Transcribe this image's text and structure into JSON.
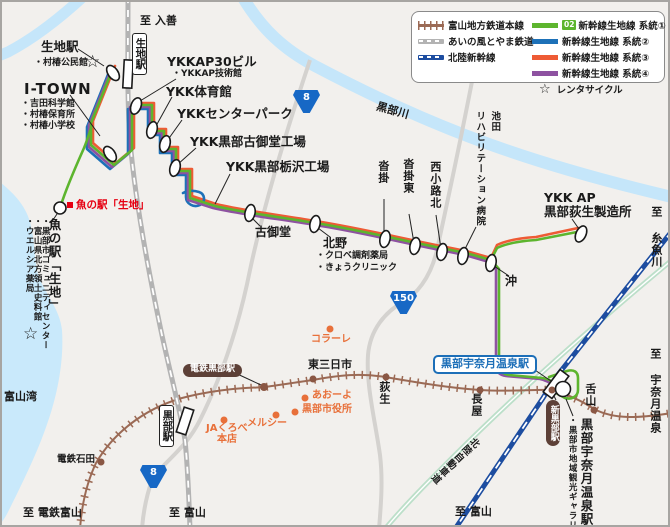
{
  "colors": {
    "background": "#f2f0ed",
    "sea": "#c9e9fb",
    "river": "#c5e6fa",
    "road": "#d4d2cf",
    "chitetsu": "#9b6a55",
    "ainokaze": "#b3b3b3",
    "shinkansen": "#1d4da0",
    "expressway": "#bcdfc9",
    "route1_green": "#5db52e",
    "route2_blue": "#1d71b8",
    "route3_orange": "#ee5b35",
    "route4_purple": "#8e52a1",
    "poi_orange": "#e8703a",
    "poi_red": "#e60012",
    "shield_blue": "#1768c5",
    "badge_brown": "#5d4037",
    "station_blue": "#1d6fb8"
  },
  "legend": {
    "rail_items": [
      {
        "label": "富山地方鉄道本線",
        "type": "chitetsu"
      },
      {
        "label": "あいの風とやま鉄道",
        "type": "ainokaze"
      },
      {
        "label": "北陸新幹線",
        "type": "shinkansen"
      }
    ],
    "route_items": [
      {
        "badge": "02",
        "label": "新幹線生地線 系統①",
        "color": "#5db52e"
      },
      {
        "badge": "",
        "label": "新幹線生地線 系統②",
        "color": "#1d71b8"
      },
      {
        "badge": "",
        "label": "新幹線生地線 系統③",
        "color": "#ee5b35"
      },
      {
        "badge": "",
        "label": "新幹線生地線 系統④",
        "color": "#8e52a1"
      }
    ],
    "rental_cycle_label": "レンタサイクル",
    "rental_cycle_icon": "star-icon"
  },
  "map_labels": [
    {
      "name": "to-nyuzen-label",
      "text": "至 入善",
      "x": 140,
      "y": 15,
      "cls": "md"
    },
    {
      "name": "ikuji-bus-stop-label",
      "text": "生地駅",
      "x": 41,
      "y": 40,
      "cls": "lg"
    },
    {
      "name": "muratsubaki-kominkan-label",
      "text": "・村椿公民館",
      "x": 34,
      "y": 59,
      "cls": "sm"
    },
    {
      "name": "i-town-label",
      "text": "I-TOWN",
      "x": 24,
      "y": 81,
      "cls": "xl"
    },
    {
      "name": "yoshida-science-label",
      "text": "・吉田科学館",
      "x": 21,
      "y": 100,
      "cls": "sm"
    },
    {
      "name": "muratsubaki-hoiku-label",
      "text": "・村椿保育所",
      "x": 21,
      "y": 111,
      "cls": "sm"
    },
    {
      "name": "muratsubaki-shogakko-label",
      "text": "・村椿小学校",
      "x": 21,
      "y": 122,
      "cls": "sm"
    },
    {
      "name": "ikuji-rail-station-box",
      "text": "生地駅",
      "x": 132,
      "y": 33,
      "cls": "stationbox"
    },
    {
      "name": "ykkap30-label",
      "text": "YKKAP30ビル",
      "x": 167,
      "y": 55,
      "cls": "lg"
    },
    {
      "name": "ykkap-gijutsukan-label",
      "text": "・YKKAP技術館",
      "x": 172,
      "y": 70,
      "cls": "sm"
    },
    {
      "name": "ykk-taiikukan-label",
      "text": "YKK体育館",
      "x": 166,
      "y": 85,
      "cls": "lg"
    },
    {
      "name": "ykk-center-park-label",
      "text": "YKKセンターパーク",
      "x": 177,
      "y": 107,
      "cls": "lg"
    },
    {
      "name": "ykk-komido-kojo-label",
      "text": "YKK黒部古御堂工場",
      "x": 190,
      "y": 135,
      "cls": "lg"
    },
    {
      "name": "ykk-tochizawa-kojo-label",
      "text": "YKK黒部栃沢工場",
      "x": 226,
      "y": 160,
      "cls": "lg"
    },
    {
      "name": "kurobe-river-label",
      "text": "黒部川",
      "x": 376,
      "y": 105,
      "cls": "md",
      "rot": 16
    },
    {
      "name": "ikeda-hospital-label-1",
      "text": "池田",
      "x": 489,
      "y": 111,
      "cls": "vert smd"
    },
    {
      "name": "ikeda-hospital-label-2",
      "text": "リハビリテーション病院",
      "x": 474,
      "y": 111,
      "cls": "vert smd"
    },
    {
      "name": "kutsukake-label",
      "text": "沓掛",
      "x": 377,
      "y": 160,
      "cls": "vert md"
    },
    {
      "name": "kutsukake-higashi-label",
      "text": "沓掛東",
      "x": 402,
      "y": 158,
      "cls": "vert md"
    },
    {
      "name": "nishikoji-kita-label",
      "text": "西小路北",
      "x": 429,
      "y": 161,
      "cls": "vert md"
    },
    {
      "name": "ykk-ap-label-1",
      "text": "YKK AP",
      "x": 544,
      "y": 191,
      "cls": "lg"
    },
    {
      "name": "ykk-ap-label-2",
      "text": "黒部荻生製造所",
      "x": 544,
      "y": 205,
      "cls": "lg"
    },
    {
      "name": "to-itoigawa-label",
      "text": "至 糸魚川",
      "x": 650,
      "y": 206,
      "cls": "vert md"
    },
    {
      "name": "komido-stop-label",
      "text": "古御堂",
      "x": 255,
      "y": 226,
      "cls": "mdd"
    },
    {
      "name": "kitano-stop-label",
      "text": "北野",
      "x": 323,
      "y": 237,
      "cls": "mdd"
    },
    {
      "name": "kurobe-pharmacy-label",
      "text": "・クロベ調剤薬局",
      "x": 316,
      "y": 252,
      "cls": "sm"
    },
    {
      "name": "kyo-clinic-label",
      "text": "・きょうクリニック",
      "x": 316,
      "y": 264,
      "cls": "sm"
    },
    {
      "name": "oki-stop-label",
      "text": "沖",
      "x": 505,
      "y": 275,
      "cls": "mdd"
    },
    {
      "name": "uonoeki-poi-label",
      "text": "魚の駅「生地」",
      "x": 76,
      "y": 200,
      "cls": "red"
    },
    {
      "name": "uonoeki-stop-label",
      "text": "魚の駅「生地」",
      "x": 47,
      "y": 218,
      "cls": "vert lg"
    },
    {
      "name": "community-center-label",
      "text": "・黒部市コミュニティセンター",
      "x": 40,
      "y": 217,
      "cls": "vert xs"
    },
    {
      "name": "hoppo-shiryokan-label",
      "text": "・富山県北方領土史料館",
      "x": 32,
      "y": 217,
      "cls": "vert xs"
    },
    {
      "name": "welcia-label",
      "text": "・ウエルシア薬局",
      "x": 24,
      "y": 217,
      "cls": "vert xs"
    },
    {
      "name": "toyama-bay-label",
      "text": "富山湾",
      "x": 4,
      "y": 391,
      "cls": "md"
    },
    {
      "name": "colare-label",
      "text": "コラーレ",
      "x": 311,
      "y": 335,
      "cls": "poi"
    },
    {
      "name": "dentetsu-kurobe-badge",
      "text": "電鉄黒部駅",
      "x": 183,
      "y": 364,
      "cls": "badge"
    },
    {
      "name": "higashi-mikkaichi-label",
      "text": "東三日市",
      "x": 308,
      "y": 359,
      "cls": "md"
    },
    {
      "name": "aoyo-label",
      "text": "あおーよ",
      "x": 312,
      "y": 391,
      "cls": "poi"
    },
    {
      "name": "kurobe-cityhall-label",
      "text": "黒部市役所",
      "x": 302,
      "y": 405,
      "cls": "poi"
    },
    {
      "name": "mercy-label",
      "text": "メルシー",
      "x": 247,
      "y": 419,
      "cls": "poi"
    },
    {
      "name": "ja-kurobe-label-1",
      "text": "JAくろべ",
      "x": 206,
      "y": 424,
      "cls": "poi"
    },
    {
      "name": "ja-kurobe-label-2",
      "text": "本店",
      "x": 217,
      "y": 435,
      "cls": "poi"
    },
    {
      "name": "ogyu-label",
      "text": "荻生",
      "x": 378,
      "y": 381,
      "cls": "vert md"
    },
    {
      "name": "kurobe-sta-box",
      "text": "黒部駅",
      "x": 159,
      "y": 405,
      "cls": "stationbox"
    },
    {
      "name": "nagaya-label",
      "text": "長屋",
      "x": 470,
      "y": 393,
      "cls": "vert md"
    },
    {
      "name": "shitayama-label",
      "text": "舌山",
      "x": 584,
      "y": 383,
      "cls": "vert md"
    },
    {
      "name": "kurobe-unazuki-box",
      "text": "黒部宇奈月温泉駅",
      "x": 433,
      "y": 355,
      "cls": "bluebox"
    },
    {
      "name": "shin-kurobe-badge",
      "text": "新黒部駅",
      "x": 546,
      "y": 400,
      "cls": "badge-v"
    },
    {
      "name": "kurobe-unazuki-vert-label",
      "text": "黒部宇奈月温泉駅",
      "x": 579,
      "y": 418,
      "cls": "vert lg"
    },
    {
      "name": "kanko-gallery-label",
      "text": "・黒部市地域観光ギャラリー",
      "x": 567,
      "y": 416,
      "cls": "vert xs"
    },
    {
      "name": "to-unazuki-label",
      "text": "至 宇奈月温泉",
      "x": 649,
      "y": 348,
      "cls": "vert md"
    },
    {
      "name": "to-toyama-shinkansen-label",
      "text": "至 富山",
      "x": 455,
      "y": 506,
      "cls": "md"
    },
    {
      "name": "to-toyama-ainokaze-label",
      "text": "至 富山",
      "x": 169,
      "y": 507,
      "cls": "md"
    },
    {
      "name": "to-dentetsu-toyama-label",
      "text": "至 電鉄富山",
      "x": 23,
      "y": 507,
      "cls": "md"
    },
    {
      "name": "hokuriku-expressway-label",
      "text": "北陸自動車道",
      "x": 449,
      "y": 428,
      "cls": "vert smd",
      "rot": 47
    },
    {
      "name": "dentetsu-ishida-label",
      "text": "電鉄石田",
      "x": 57,
      "y": 455,
      "cls": "smd"
    }
  ],
  "shields": [
    {
      "name": "route-8-shield-north",
      "text": "8",
      "x": 293,
      "y": 90
    },
    {
      "name": "route-8-shield-south",
      "text": "8",
      "x": 140,
      "y": 465
    },
    {
      "name": "route-150-shield",
      "text": "150",
      "x": 390,
      "y": 291
    }
  ],
  "stars": [
    {
      "name": "rental-cycle-star-kominkan",
      "x": 85,
      "y": 54
    },
    {
      "name": "rental-cycle-star-uonoeki",
      "x": 23,
      "y": 326
    }
  ]
}
